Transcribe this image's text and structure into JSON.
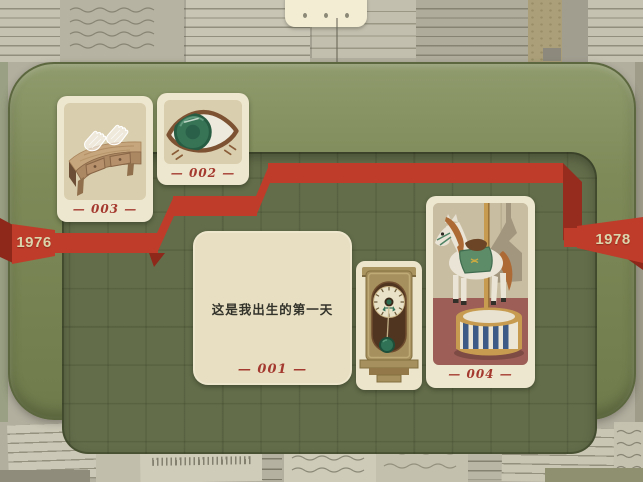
{
  "handle": {
    "icon": "three-dots-drawer-handle"
  },
  "timeline": {
    "year_left": "1976",
    "year_right": "1978"
  },
  "cards": {
    "c001": {
      "label": "— 001 —",
      "text": "这是我出生的第一天",
      "type": "text-card"
    },
    "c002": {
      "label": "— 002 —",
      "illustration": "eye"
    },
    "c003": {
      "label": "— 003 —",
      "illustration": "table-with-lace-gloves"
    },
    "c004": {
      "label": "— 004 —",
      "illustration": "carousel-horse"
    },
    "clock": {
      "illustration": "pendulum-wall-clock"
    }
  },
  "colors": {
    "ribbon": "#bf3c2a",
    "ribbon_dark": "#8e281b",
    "board_rim": "#7e8a58",
    "board_floor": "#636d4a",
    "card_bg": "#eee7cf",
    "card_panel": "#d9cead",
    "label_red": "#a4392f",
    "year_text": "#dcd5ac",
    "paper": "#c6c2b2"
  }
}
